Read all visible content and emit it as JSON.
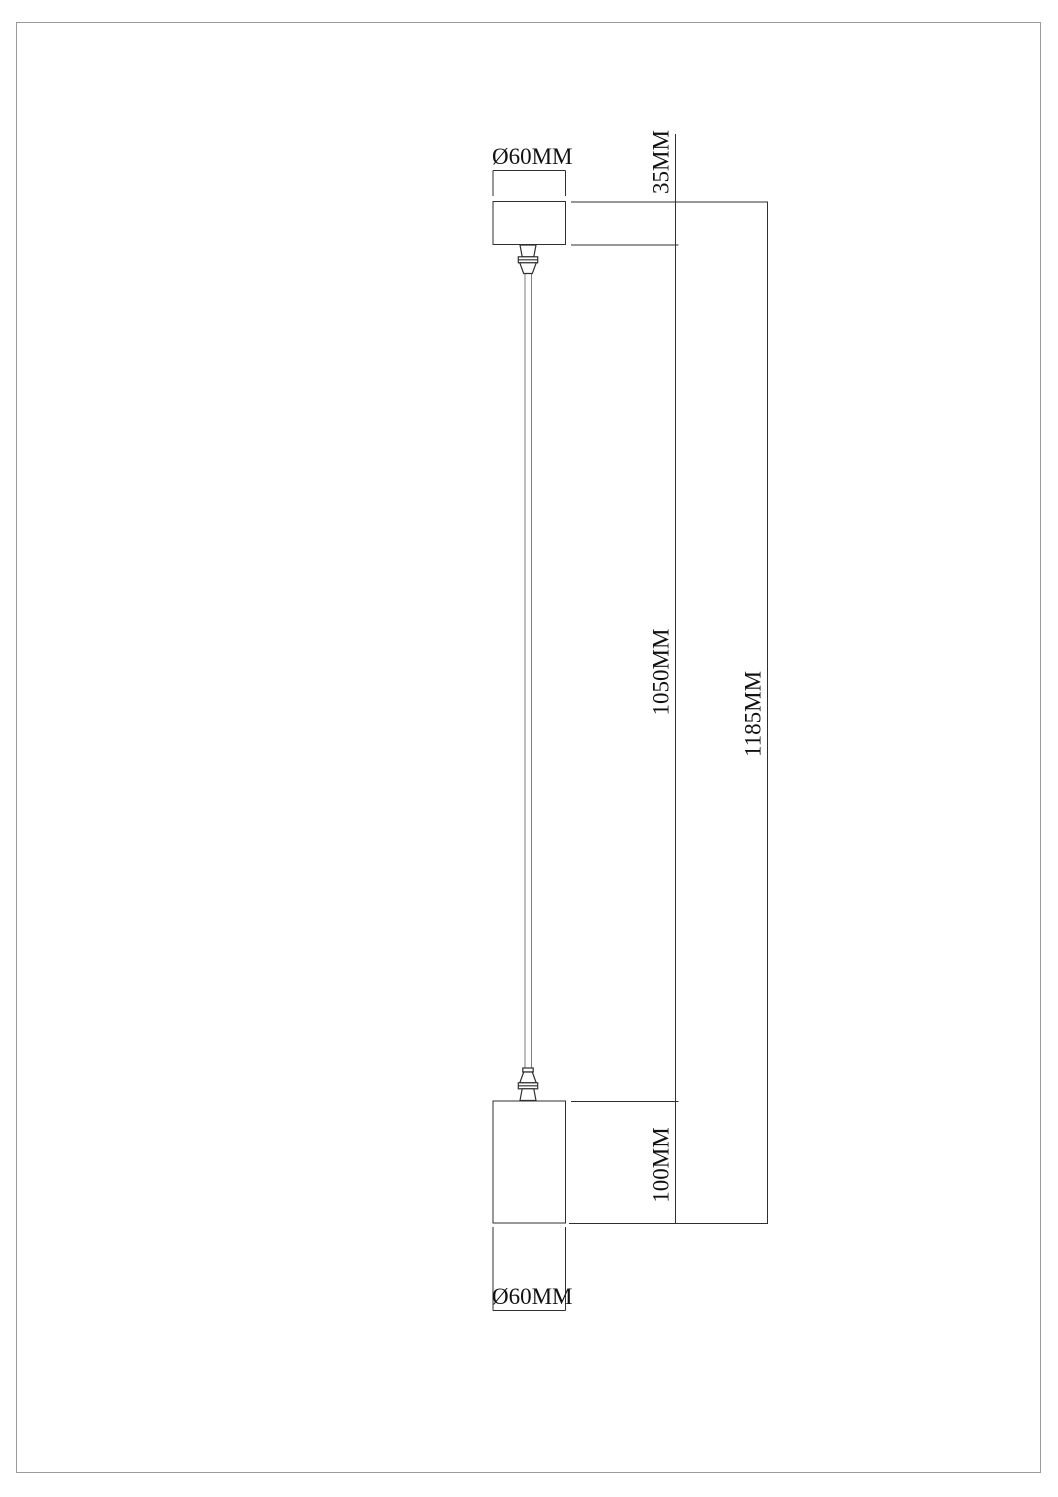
{
  "drawing": {
    "title": "Pendant lamp dimension drawing",
    "labels": {
      "canopy_diameter": "Ø60MM",
      "canopy_height": "35MM",
      "cable_length": "1050MM",
      "total_height": "1185MM",
      "body_height": "100MM",
      "body_diameter": "Ø60MM"
    },
    "dimensions_mm": {
      "canopy_diameter": 60,
      "canopy_height": 35,
      "cable_length": 1050,
      "total_height": 1185,
      "body_height": 100,
      "body_diameter": 60
    },
    "colors": {
      "line": "#2f2f2f",
      "cable": "#7d7d7d",
      "frame": "#9a9a9a",
      "text": "#111111",
      "background": "#ffffff"
    }
  }
}
